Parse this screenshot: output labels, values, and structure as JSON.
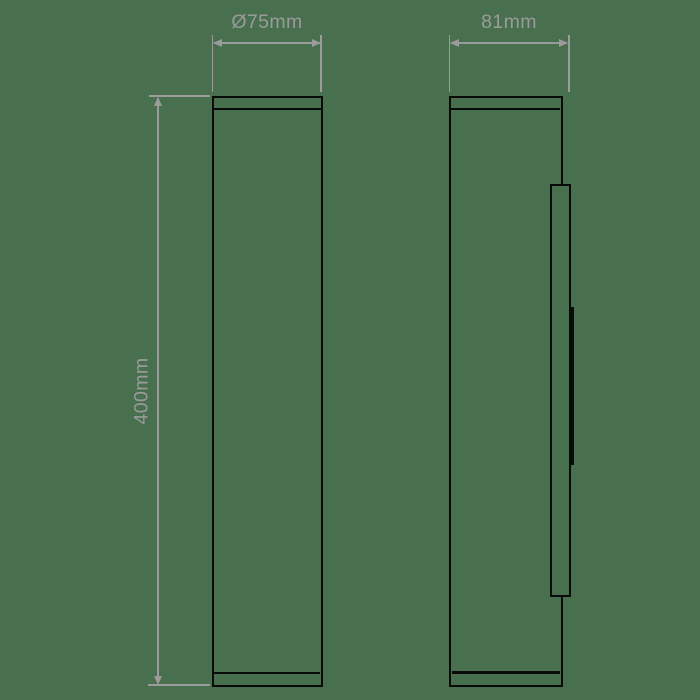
{
  "colors": {
    "background": "#48704e",
    "line": "#0a0a0a",
    "dimension": "#9b9b9b"
  },
  "dimensions": {
    "diameter": {
      "label": "Ø75mm"
    },
    "depth": {
      "label": "81mm"
    },
    "height": {
      "label": "400mm"
    }
  }
}
